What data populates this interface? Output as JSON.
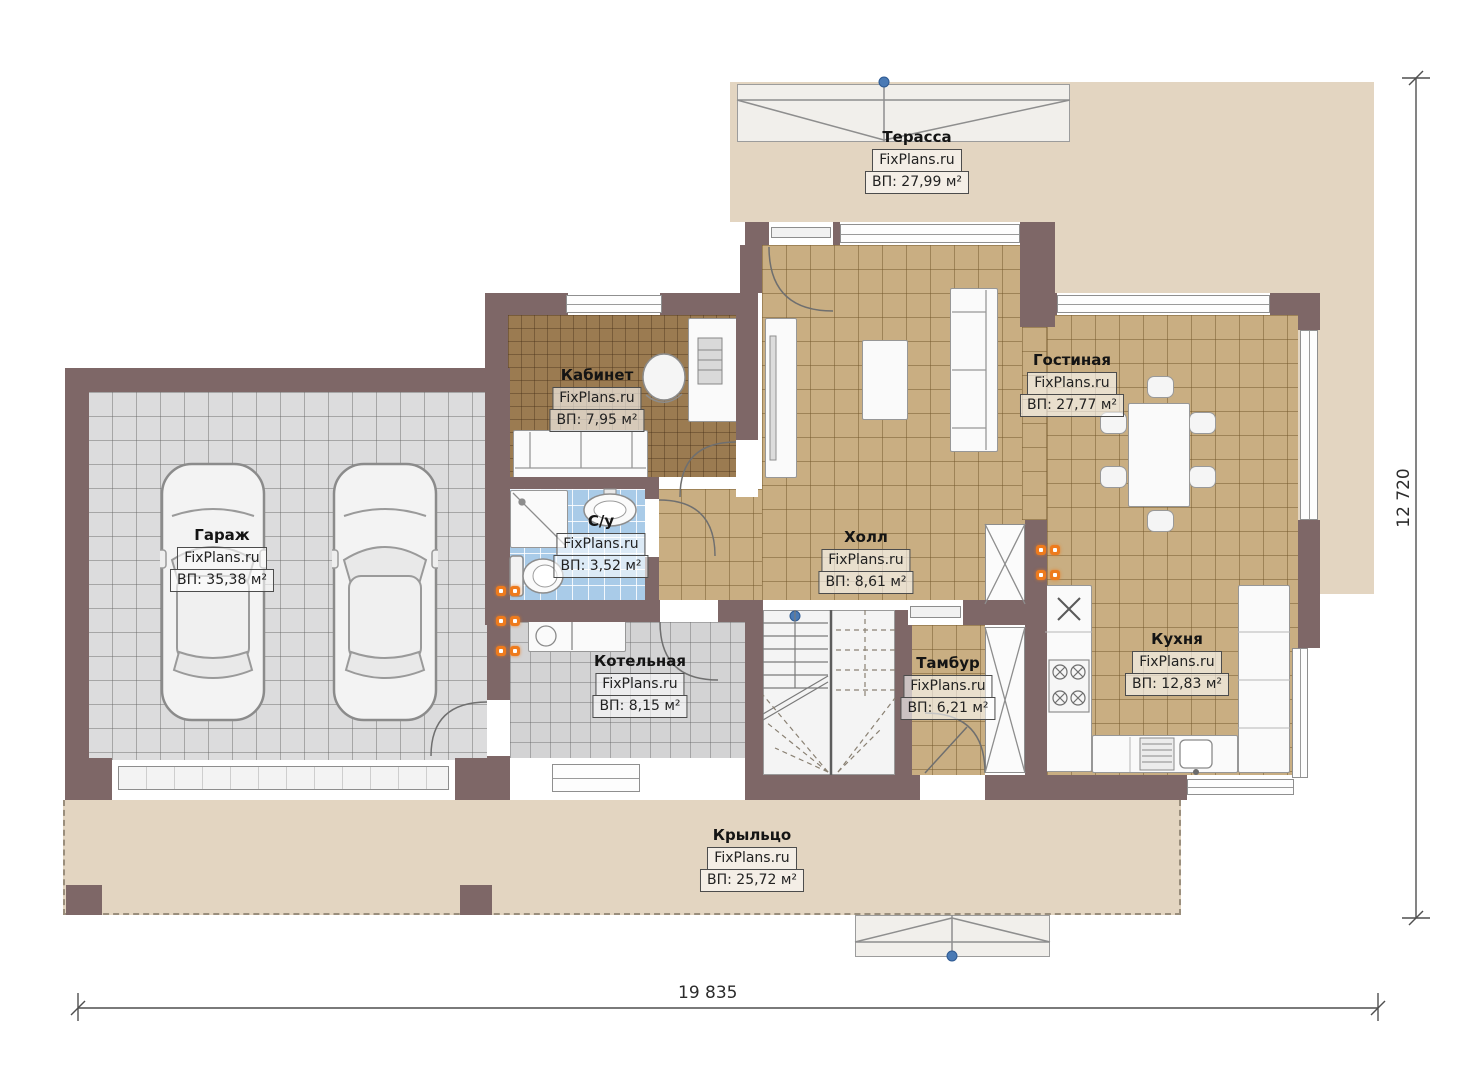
{
  "watermark": "FixPlans.ru",
  "rooms": [
    {
      "id": "terrace",
      "name": "Терасса",
      "area": "ВП: 27,99 м²"
    },
    {
      "id": "office",
      "name": "Кабинет",
      "area": "ВП: 7,95 м²"
    },
    {
      "id": "living",
      "name": "Гостиная",
      "area": "ВП: 27,77 м²"
    },
    {
      "id": "garage",
      "name": "Гараж",
      "area": "ВП: 35,38 м²"
    },
    {
      "id": "bathroom",
      "name": "С/у",
      "area": "ВП: 3,52 м²"
    },
    {
      "id": "hall",
      "name": "Холл",
      "area": "ВП: 8,61 м²"
    },
    {
      "id": "kitchen",
      "name": "Кухня",
      "area": "ВП: 12,83 м²"
    },
    {
      "id": "boiler",
      "name": "Котельная",
      "area": "ВП: 8,15 м²"
    },
    {
      "id": "vestibule",
      "name": "Тамбур",
      "area": "ВП: 6,21 м²"
    },
    {
      "id": "porch",
      "name": "Крыльцо",
      "area": "ВП: 25,72 м²"
    }
  ],
  "dimensions": {
    "bottom": "19 835",
    "right": "12 720"
  },
  "colors": {
    "wall": "#7e6767",
    "floor_tile_tan": "#c9ae82",
    "floor_tile_gray": "#dcdcdd",
    "floor_tile_blue": "#a9cbe8",
    "floor_wood": "#9b7b51",
    "outdoor_beige": "#e3d5c1",
    "radiator_orange": "#ee7b1d",
    "marker_blue": "#4a7ab5"
  }
}
